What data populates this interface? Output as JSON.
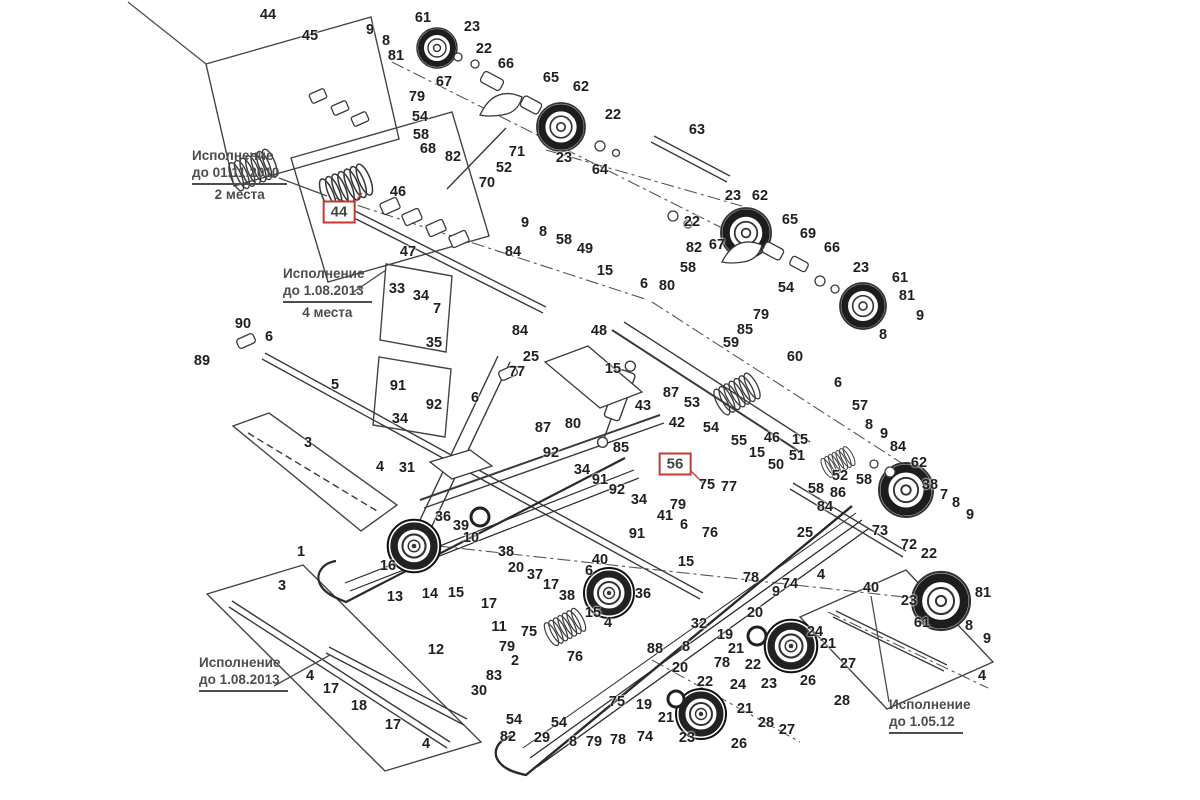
{
  "canvas": {
    "width": 1200,
    "height": 800,
    "background": "#ffffff"
  },
  "colors": {
    "line": "#3a3a3a",
    "dark": "#1e1e1e",
    "highlight_box": "#c23a31",
    "note_text": "#4d4d4d",
    "label_text": "#1f1f1f"
  },
  "annotations": [
    {
      "id": "note-2010",
      "line1": "Исполнение",
      "line2": "до 01.11.2010",
      "sub": "2 места",
      "x": 192,
      "y": 148
    },
    {
      "id": "note-2013-4",
      "line1": "Исполнение",
      "line2": "до 1.08.2013",
      "sub": "4 места",
      "x": 283,
      "y": 266
    },
    {
      "id": "note-2013",
      "line1": "Исполнение",
      "line2": "до 1.08.2013",
      "sub": "",
      "x": 199,
      "y": 655
    },
    {
      "id": "note-2012",
      "line1": "Исполнение",
      "line2": "до 1.05.12",
      "sub": "",
      "x": 889,
      "y": 697
    }
  ],
  "highlighted_labels": [
    {
      "text": "44",
      "x": 339,
      "y": 212
    },
    {
      "text": "56",
      "x": 675,
      "y": 464
    }
  ],
  "part_labels": [
    [
      "44",
      268,
      15
    ],
    [
      "45",
      310,
      36
    ],
    [
      "9",
      370,
      30
    ],
    [
      "8",
      386,
      41
    ],
    [
      "61",
      423,
      18
    ],
    [
      "81",
      396,
      56
    ],
    [
      "23",
      472,
      27
    ],
    [
      "22",
      484,
      49
    ],
    [
      "66",
      506,
      64
    ],
    [
      "67",
      444,
      82
    ],
    [
      "79",
      417,
      97
    ],
    [
      "54",
      420,
      117
    ],
    [
      "58",
      421,
      135
    ],
    [
      "68",
      428,
      149
    ],
    [
      "82",
      453,
      157
    ],
    [
      "71",
      517,
      152
    ],
    [
      "52",
      504,
      168
    ],
    [
      "70",
      487,
      183
    ],
    [
      "46",
      398,
      192
    ],
    [
      "65",
      551,
      78
    ],
    [
      "62",
      581,
      87
    ],
    [
      "22",
      613,
      115
    ],
    [
      "63",
      697,
      130
    ],
    [
      "23",
      564,
      158
    ],
    [
      "64",
      600,
      170
    ],
    [
      "47",
      408,
      252
    ],
    [
      "23",
      733,
      196
    ],
    [
      "62",
      760,
      196
    ],
    [
      "22",
      692,
      222
    ],
    [
      "65",
      790,
      220
    ],
    [
      "69",
      808,
      234
    ],
    [
      "66",
      832,
      248
    ],
    [
      "82",
      694,
      248
    ],
    [
      "67",
      717,
      245
    ],
    [
      "58",
      688,
      268
    ],
    [
      "54",
      786,
      288
    ],
    [
      "79",
      761,
      315
    ],
    [
      "23",
      861,
      268
    ],
    [
      "61",
      900,
      278
    ],
    [
      "81",
      907,
      296
    ],
    [
      "9",
      920,
      316
    ],
    [
      "8",
      883,
      335
    ],
    [
      "9",
      525,
      223
    ],
    [
      "8",
      543,
      232
    ],
    [
      "58",
      564,
      240
    ],
    [
      "49",
      585,
      249
    ],
    [
      "84",
      513,
      252
    ],
    [
      "15",
      605,
      271
    ],
    [
      "6",
      644,
      284
    ],
    [
      "80",
      667,
      286
    ],
    [
      "85",
      745,
      330
    ],
    [
      "59",
      731,
      343
    ],
    [
      "60",
      795,
      357
    ],
    [
      "48",
      599,
      331
    ],
    [
      "84",
      520,
      331
    ],
    [
      "25",
      531,
      357
    ],
    [
      "77",
      517,
      372
    ],
    [
      "15",
      613,
      369
    ],
    [
      "6",
      475,
      398
    ],
    [
      "87",
      671,
      393
    ],
    [
      "43",
      643,
      406
    ],
    [
      "53",
      692,
      403
    ],
    [
      "80",
      573,
      424
    ],
    [
      "85",
      621,
      448
    ],
    [
      "90",
      243,
      324
    ],
    [
      "6",
      269,
      337
    ],
    [
      "89",
      202,
      361
    ],
    [
      "5",
      335,
      385
    ],
    [
      "33",
      397,
      289
    ],
    [
      "34",
      421,
      296
    ],
    [
      "7",
      437,
      309
    ],
    [
      "35",
      434,
      343
    ],
    [
      "91",
      398,
      386
    ],
    [
      "92",
      434,
      405
    ],
    [
      "34",
      400,
      419
    ],
    [
      "3",
      308,
      443
    ],
    [
      "4",
      380,
      467
    ],
    [
      "31",
      407,
      468
    ],
    [
      "3",
      282,
      586
    ],
    [
      "1",
      301,
      552
    ],
    [
      "42",
      677,
      423
    ],
    [
      "54",
      711,
      428
    ],
    [
      "55",
      739,
      441
    ],
    [
      "46",
      772,
      438
    ],
    [
      "15",
      800,
      440
    ],
    [
      "15",
      757,
      453
    ],
    [
      "51",
      797,
      456
    ],
    [
      "50",
      776,
      465
    ],
    [
      "52",
      840,
      476
    ],
    [
      "58",
      864,
      480
    ],
    [
      "86",
      838,
      493
    ],
    [
      "58",
      816,
      489
    ],
    [
      "84",
      825,
      507
    ],
    [
      "6",
      838,
      383
    ],
    [
      "57",
      860,
      406
    ],
    [
      "8",
      869,
      425
    ],
    [
      "9",
      884,
      434
    ],
    [
      "84",
      898,
      447
    ],
    [
      "62",
      919,
      463
    ],
    [
      "38",
      930,
      485
    ],
    [
      "7",
      944,
      495
    ],
    [
      "8",
      956,
      503
    ],
    [
      "9",
      970,
      515
    ],
    [
      "73",
      880,
      531
    ],
    [
      "72",
      909,
      545
    ],
    [
      "22",
      929,
      554
    ],
    [
      "25",
      805,
      533
    ],
    [
      "75",
      707,
      485
    ],
    [
      "77",
      729,
      487
    ],
    [
      "79",
      678,
      505
    ],
    [
      "41",
      665,
      516
    ],
    [
      "6",
      684,
      525
    ],
    [
      "76",
      710,
      533
    ],
    [
      "87",
      543,
      428
    ],
    [
      "92",
      551,
      453
    ],
    [
      "34",
      582,
      470
    ],
    [
      "91",
      600,
      480
    ],
    [
      "92",
      617,
      490
    ],
    [
      "34",
      639,
      500
    ],
    [
      "91",
      637,
      534
    ],
    [
      "36",
      443,
      517
    ],
    [
      "39",
      461,
      526
    ],
    [
      "10",
      471,
      538
    ],
    [
      "38",
      506,
      552
    ],
    [
      "20",
      516,
      568
    ],
    [
      "37",
      535,
      575
    ],
    [
      "17",
      551,
      585
    ],
    [
      "14",
      430,
      594
    ],
    [
      "15",
      456,
      593
    ],
    [
      "17",
      489,
      604
    ],
    [
      "38",
      567,
      596
    ],
    [
      "40",
      600,
      560
    ],
    [
      "6",
      589,
      571
    ],
    [
      "36",
      643,
      594
    ],
    [
      "15",
      593,
      613
    ],
    [
      "15",
      686,
      562
    ],
    [
      "4",
      608,
      623
    ],
    [
      "16",
      388,
      566
    ],
    [
      "13",
      395,
      597
    ],
    [
      "12",
      436,
      650
    ],
    [
      "4",
      310,
      676
    ],
    [
      "17",
      331,
      689
    ],
    [
      "18",
      359,
      706
    ],
    [
      "17",
      393,
      725
    ],
    [
      "4",
      426,
      744
    ],
    [
      "11",
      499,
      627
    ],
    [
      "30",
      479,
      691
    ],
    [
      "83",
      494,
      676
    ],
    [
      "2",
      515,
      661
    ],
    [
      "79",
      507,
      647
    ],
    [
      "75",
      529,
      632
    ],
    [
      "76",
      575,
      657
    ],
    [
      "54",
      514,
      720
    ],
    [
      "82",
      508,
      737
    ],
    [
      "29",
      542,
      738
    ],
    [
      "54",
      559,
      723
    ],
    [
      "8",
      573,
      742
    ],
    [
      "79",
      594,
      742
    ],
    [
      "78",
      618,
      740
    ],
    [
      "74",
      645,
      737
    ],
    [
      "75",
      617,
      702
    ],
    [
      "19",
      644,
      705
    ],
    [
      "21",
      666,
      718
    ],
    [
      "23",
      687,
      738
    ],
    [
      "88",
      655,
      649
    ],
    [
      "8",
      686,
      647
    ],
    [
      "20",
      680,
      668
    ],
    [
      "22",
      705,
      682
    ],
    [
      "32",
      699,
      624
    ],
    [
      "19",
      725,
      635
    ],
    [
      "21",
      736,
      649
    ],
    [
      "78",
      722,
      663
    ],
    [
      "20",
      755,
      613
    ],
    [
      "22",
      753,
      665
    ],
    [
      "23",
      769,
      684
    ],
    [
      "24",
      738,
      685
    ],
    [
      "21",
      745,
      709
    ],
    [
      "26",
      739,
      744
    ],
    [
      "28",
      766,
      723
    ],
    [
      "27",
      787,
      730
    ],
    [
      "24",
      815,
      632
    ],
    [
      "21",
      828,
      644
    ],
    [
      "27",
      848,
      664
    ],
    [
      "26",
      808,
      681
    ],
    [
      "28",
      842,
      701
    ],
    [
      "4",
      821,
      575
    ],
    [
      "40",
      871,
      588
    ],
    [
      "23",
      909,
      601
    ],
    [
      "61",
      922,
      623
    ],
    [
      "81",
      983,
      593
    ],
    [
      "8",
      969,
      626
    ],
    [
      "9",
      987,
      639
    ],
    [
      "4",
      982,
      676
    ],
    [
      "74",
      790,
      584
    ],
    [
      "9",
      776,
      592
    ],
    [
      "78",
      751,
      578
    ]
  ]
}
